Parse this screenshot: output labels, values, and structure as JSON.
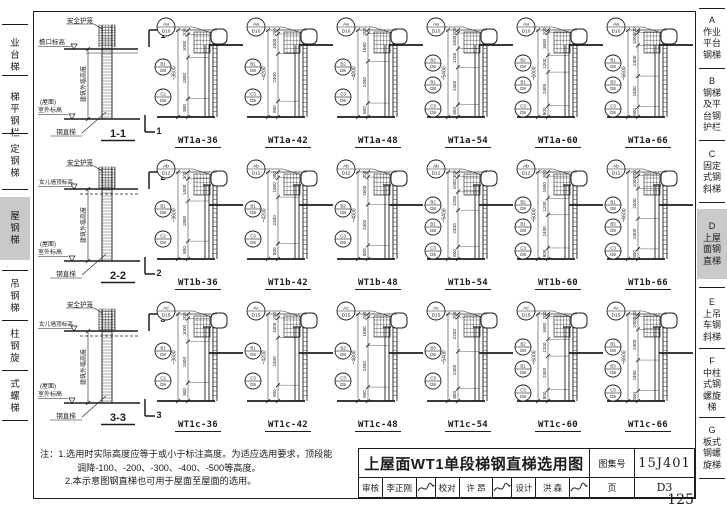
{
  "page": {
    "number": "125"
  },
  "palette": {
    "line": "#1c1c1c",
    "highlight": "#c9c9c9",
    "paper": "#ffffff"
  },
  "left_tabs": [
    {
      "label": "业台梯",
      "active": false
    },
    {
      "label": "梯平钢栏",
      "active": false
    },
    {
      "label": "定钢梯",
      "active": false
    },
    {
      "label": "屋钢梯",
      "active": true
    },
    {
      "label": "吊钢梯",
      "active": false
    },
    {
      "label": "柱钢旋",
      "active": false
    },
    {
      "label": "式螺梯",
      "active": false
    }
  ],
  "right_tabs": [
    {
      "key": "A",
      "lines": [
        "作业",
        "平台",
        "钢梯"
      ],
      "active": false
    },
    {
      "key": "B",
      "lines": [
        "钢梯",
        "及平",
        "台钢",
        "护栏"
      ],
      "active": false
    },
    {
      "key": "C",
      "lines": [
        "固定",
        "式钢",
        "斜梯"
      ],
      "active": false
    },
    {
      "key": "D",
      "lines": [
        "上屋",
        "面钢",
        "直梯"
      ],
      "active": true
    },
    {
      "key": "E",
      "lines": [
        "上吊",
        "车钢",
        "斜梯"
      ],
      "active": false
    },
    {
      "key": "F",
      "lines": [
        "中柱",
        "式钢",
        "螺旋",
        "梯"
      ],
      "active": false
    },
    {
      "key": "G",
      "lines": [
        "板式",
        "钢螺",
        "旋梯"
      ],
      "active": false
    }
  ],
  "rows": [
    {
      "section": "1-1",
      "cut": "1",
      "top_callout": {
        "top": "Aa",
        "btm": "D10"
      },
      "labels": {
        "cage": "安全护笼",
        "top_elev": "檐口标高",
        "wall": "建筑外墙高度",
        "ground1": "(屋面)",
        "ground2": "室外标高",
        "ladder": "钢直梯"
      },
      "diagrams": [
        {
          "name": "WT1a-36",
          "total": "~3600",
          "dims": [
            "200",
            "1000",
            "1800",
            "800"
          ],
          "side": [
            [
              "B1",
              "D8"
            ],
            [
              "C2",
              "D9"
            ]
          ]
        },
        {
          "name": "WT1a-42",
          "total": "~4200",
          "dims": [
            "200",
            "1000",
            "2400",
            "800"
          ],
          "side": [
            [
              "B1",
              "D8"
            ],
            [
              "C3",
              "D9"
            ]
          ]
        },
        {
          "name": "WT1a-48",
          "total": "~4800",
          "dims": [
            "200",
            "1600",
            "2400",
            "800"
          ],
          "side": [
            [
              "B2",
              "D8"
            ],
            [
              "C3",
              "D9"
            ]
          ]
        },
        {
          "name": "WT1a-54",
          "total": "~5400",
          "dims": [
            "200",
            "1000",
            "1200",
            "2400",
            "800"
          ],
          "side": [
            [
              "B2",
              "D8"
            ],
            [
              "B1",
              "D8"
            ],
            [
              "C3",
              "D9"
            ]
          ]
        },
        {
          "name": "WT1a-60",
          "total": "~6000",
          "dims": [
            "200",
            "1600",
            "1200",
            "2400",
            "800"
          ],
          "side": [
            [
              "B2",
              "D8"
            ],
            [
              "B1",
              "D8"
            ],
            [
              "C3",
              "D9"
            ]
          ]
        },
        {
          "name": "WT1a-66",
          "total": "~6600",
          "dims": [
            "200",
            "1000",
            "2400",
            "2400",
            "800"
          ],
          "side": [
            [
              "B1",
              "D8"
            ],
            [
              "B3",
              "D8"
            ],
            [
              "C3",
              "D9"
            ]
          ]
        }
      ]
    },
    {
      "section": "2-2",
      "cut": "2",
      "top_callout": {
        "top": "Ab",
        "btm": "D12"
      },
      "labels": {
        "cage": "安全护笼",
        "top_elev": "女儿墙顶标高",
        "wall": "建筑外墙高度",
        "ground1": "(屋面)",
        "ground2": "室外标高",
        "ladder": "钢直梯"
      },
      "diagrams": [
        {
          "name": "WT1b-36",
          "total": "~3600",
          "dims": [
            "300",
            "1000",
            "1800",
            "800"
          ],
          "side": [
            [
              "B1",
              "D8"
            ],
            [
              "C2",
              "D9"
            ]
          ]
        },
        {
          "name": "WT1b-42",
          "total": "~4200",
          "dims": [
            "300",
            "1000",
            "2400",
            "800"
          ],
          "side": [
            [
              "B1",
              "D8"
            ],
            [
              "C3",
              "D9"
            ]
          ]
        },
        {
          "name": "WT1b-48",
          "total": "~4800",
          "dims": [
            "300",
            "1600",
            "2400",
            "800"
          ],
          "side": [
            [
              "B2",
              "D8"
            ],
            [
              "C3",
              "D9"
            ]
          ]
        },
        {
          "name": "WT1b-54",
          "total": "~5400",
          "dims": [
            "300",
            "1000",
            "1200",
            "2400",
            "800"
          ],
          "side": [
            [
              "B2",
              "D8"
            ],
            [
              "B1",
              "D8"
            ],
            [
              "C3",
              "D9"
            ]
          ]
        },
        {
          "name": "WT1b-60",
          "total": "~6000",
          "dims": [
            "300",
            "1600",
            "1200",
            "2400",
            "800"
          ],
          "side": [
            [
              "B2",
              "D8"
            ],
            [
              "B1",
              "D8"
            ],
            [
              "C3",
              "D9"
            ]
          ]
        },
        {
          "name": "WT1b-66",
          "total": "~6600",
          "dims": [
            "300",
            "1000",
            "2400",
            "2400",
            "800"
          ],
          "side": [
            [
              "B1",
              "D8"
            ],
            [
              "B3",
              "D8"
            ],
            [
              "C3",
              "D9"
            ]
          ]
        }
      ]
    },
    {
      "section": "3-3",
      "cut": "3",
      "top_callout": {
        "top": "Ac",
        "btm": "D15"
      },
      "labels": {
        "cage": "安全护笼",
        "top_elev": "女儿墙顶标高",
        "wall": "建筑外墙高度",
        "ground1": "(屋面)",
        "ground2": "室外标高",
        "ladder": "钢直梯"
      },
      "diagrams": [
        {
          "name": "WT1c-36",
          "total": "~3600",
          "dims": [
            "200",
            "1000",
            "1800",
            "800"
          ],
          "side": [
            [
              "B1",
              "D8"
            ],
            [
              "C2",
              "D9"
            ]
          ]
        },
        {
          "name": "WT1c-42",
          "total": "~4200",
          "dims": [
            "200",
            "1000",
            "2400",
            "800"
          ],
          "side": [
            [
              "B1",
              "D8"
            ],
            [
              "C3",
              "D9"
            ]
          ]
        },
        {
          "name": "WT1c-48",
          "total": "~4800",
          "dims": [
            "200",
            "1600",
            "2400",
            "800"
          ],
          "side": [
            [
              "B2",
              "D8"
            ],
            [
              "C3",
              "D9"
            ]
          ]
        },
        {
          "name": "WT1c-54",
          "total": "~5400",
          "dims": [
            "200",
            "2200",
            "2400",
            "800"
          ],
          "side": [
            [
              "B3",
              "D8"
            ],
            [
              "C3",
              "D9"
            ]
          ]
        },
        {
          "name": "WT1c-60",
          "total": "~6000",
          "dims": [
            "200",
            "1600",
            "1200",
            "2400",
            "800"
          ],
          "side": [
            [
              "B2",
              "D8"
            ],
            [
              "B1",
              "D8"
            ],
            [
              "C3",
              "D9"
            ]
          ]
        },
        {
          "name": "WT1c-66",
          "total": "~6600",
          "dims": [
            "200",
            "1000",
            "2400",
            "2400",
            "800"
          ],
          "side": [
            [
              "B1",
              "D8"
            ],
            [
              "B3",
              "D8"
            ],
            [
              "C3",
              "D9"
            ]
          ]
        }
      ]
    }
  ],
  "notes": {
    "lines": [
      "注：1.选用时实际高度应等于或小于标注高度。为适应选用要求，顶段能",
      "调降-100、-200、-300、-400、-500等高度。",
      "2.本示意图钢直梯也可用于屋面至屋面的选用。"
    ]
  },
  "title_block": {
    "title": "上屋面WT1单段梯钢直梯选用图",
    "atlas_label": "图集号",
    "atlas_no": "15J401",
    "page_label": "页",
    "page_no": "D3",
    "sign_cells": [
      {
        "label": "审核",
        "value": "李正刚"
      },
      {
        "label": "校对",
        "value": "许 昂"
      },
      {
        "label": "设计",
        "value": "洪 森"
      }
    ]
  }
}
